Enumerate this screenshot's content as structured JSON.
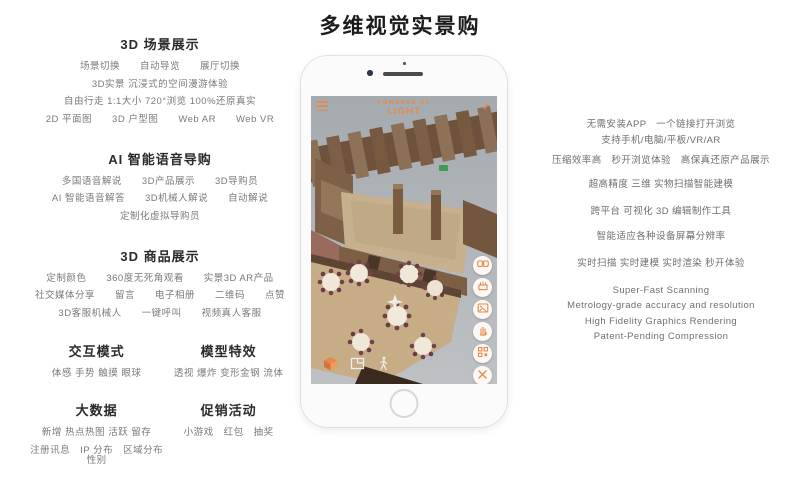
{
  "title": "多维视觉实景购",
  "colors": {
    "accent": "#E8884B",
    "heading": "#2B2B2B",
    "body_text": "#7A7A7A",
    "screen_gray": "#AEB3B7"
  },
  "left": {
    "sections": [
      {
        "heading": "3D 场景展示",
        "lines": [
          "场景切换　　自动导览　　展厅切换",
          "3D实景 沉浸式的空间漫游体验",
          "自由行走 1:1大小 720°浏览 100%还原真实",
          "2D 平面图　　3D 户型图　　Web AR　　Web VR"
        ]
      },
      {
        "heading": "AI 智能语音导购",
        "lines": [
          "多国语音解说　　3D产品展示　　3D导购员",
          "AI 智能语音解答　　3D机械人解说　　自动解说",
          "定制化虚拟导购员"
        ]
      },
      {
        "heading": "3D 商品展示",
        "lines": [
          "定制颜色　　360度无死角观看　　实景3D AR产品",
          "社交媒体分享　　留言　　电子相册　　二维码　　点赞",
          "3D客服机械人　　一键呼叫　　视频真人客服"
        ]
      }
    ],
    "dual_rows": [
      {
        "left": {
          "heading": "交互模式",
          "lines": [
            "体感  手势  触摸  眼球"
          ]
        },
        "right": {
          "heading": "模型特效",
          "lines": [
            "透视  爆炸  变形金钢  流体"
          ]
        }
      },
      {
        "left": {
          "heading": "大数据",
          "lines": [
            "新增  热点热图  活跃  留存",
            "注册讯息　IP 分布　区域分布　性别"
          ]
        },
        "right": {
          "heading": "促销活动",
          "lines": [
            "小游戏　红包　抽奖"
          ]
        }
      }
    ]
  },
  "right": {
    "blocks": [
      {
        "lines": [
          "无需安装APP　一个链接打开浏览",
          "支持手机/电脑/平板/VR/AR"
        ]
      },
      {
        "lines": [
          "压缩效率高　秒开浏览体验　高保真还原产品展示"
        ]
      },
      {
        "lines": [
          "超高精度 三维 实物扫描智能建模"
        ]
      },
      {
        "lines": [
          "跨平台 可视化 3D 编辑制作工具"
        ]
      },
      {
        "lines": [
          "智能适应各种设备屏幕分辨率"
        ]
      },
      {
        "lines": [
          "实时扫描 实时建模 实时渲染 秒开体验"
        ]
      },
      {
        "lines": [
          "Super-Fast Scanning",
          "Metrology-grade accuracy and resolution",
          "High Fidelity Graphics Rendering",
          "Patent-Pending Compression"
        ]
      }
    ]
  },
  "phone": {
    "watermark_line1": "POWERED BY",
    "watermark_line2": "LIGHT",
    "share_glyph": "⬈",
    "side_icons": [
      "vr-mode",
      "model-showcase",
      "gallery",
      "gesture",
      "qr-code",
      "close"
    ],
    "bottom_icons": [
      "dollhouse-view",
      "floorplan-view",
      "walkthrough-view"
    ]
  }
}
